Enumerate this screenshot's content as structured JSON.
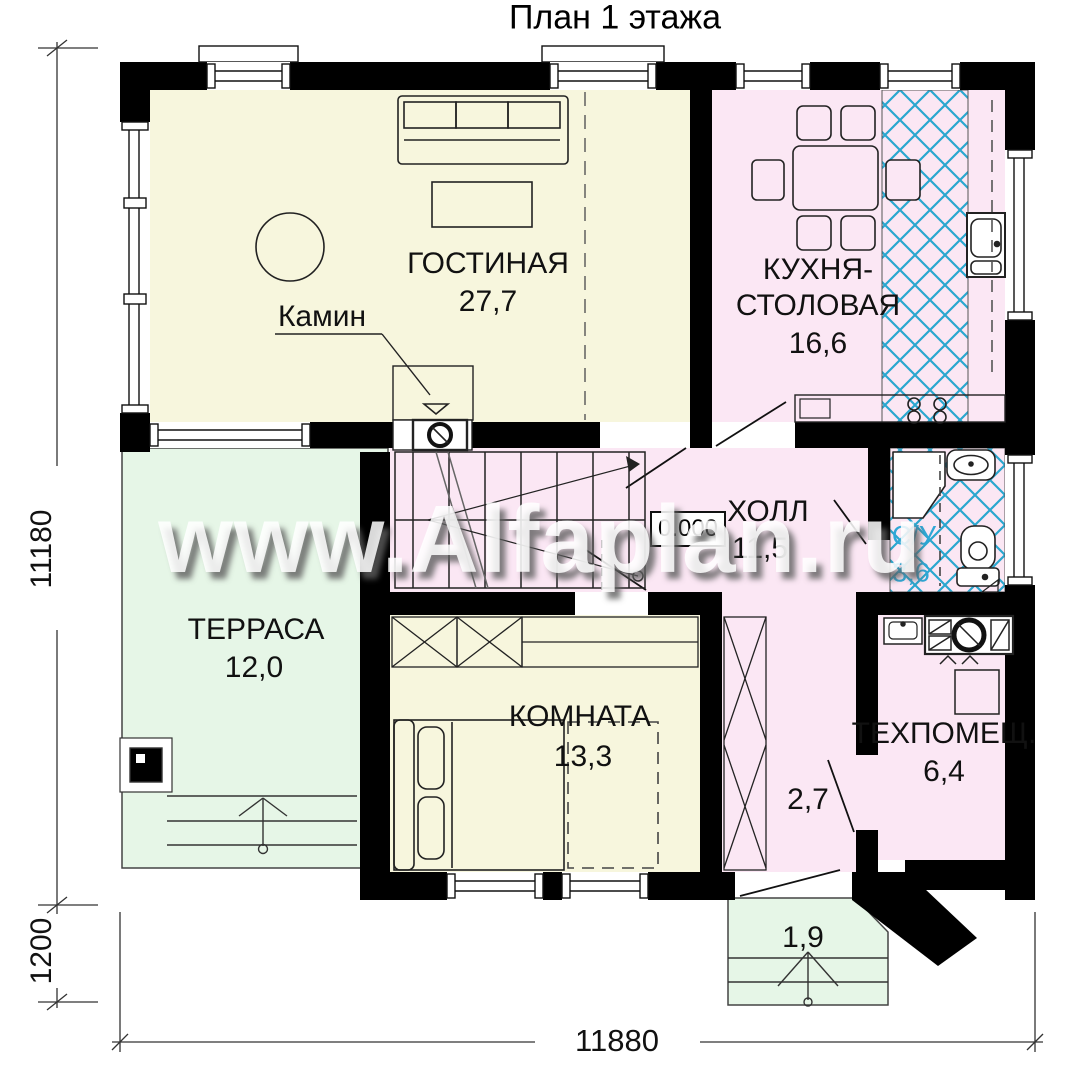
{
  "title": "План 1 этажа",
  "watermark": "www.Alfaplan.ru",
  "colors": {
    "room_cream": "#f7f6dd",
    "room_pink": "#fbe7f4",
    "room_green": "#e6f6e7",
    "tile_blue": "#2aa7cf",
    "wall_black": "#000000",
    "bath_label_blue": "#2fa7d6"
  },
  "rooms": {
    "living": {
      "name": "ГОСТИНАЯ",
      "area": "27,7"
    },
    "kitchen": {
      "name_line1": "КУХНЯ-",
      "name_line2": "СТОЛОВАЯ",
      "area": "16,6"
    },
    "hall": {
      "name": "ХОЛЛ",
      "area": "11,5"
    },
    "bathroom": {
      "name": "С/У",
      "area": "3,6"
    },
    "terrace": {
      "name": "ТЕРРАСА",
      "area": "12,0"
    },
    "bedroom": {
      "name": "КОМНАТА",
      "area": "13,3"
    },
    "tech": {
      "name": "ТЕХПОМЕЩ.",
      "area": "6,4"
    },
    "corridor": {
      "area": "2,7"
    },
    "porch": {
      "area": "1,9"
    }
  },
  "annotations": {
    "fireplace": "Камин",
    "level": "0.000"
  },
  "dimensions": {
    "height_total": "11180",
    "porch_depth": "1200",
    "width_total": "11880"
  }
}
